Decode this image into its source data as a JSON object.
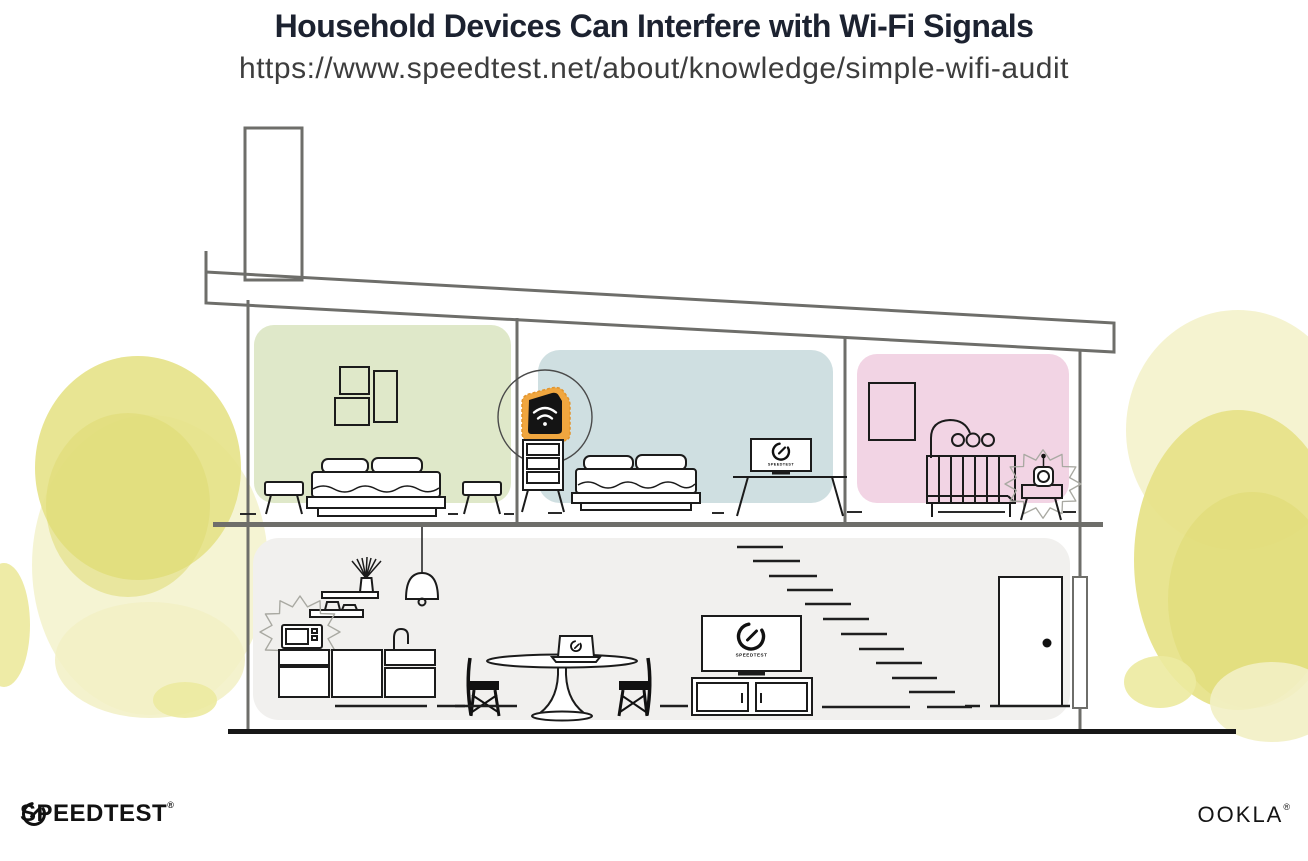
{
  "header": {
    "title": "Household Devices Can Interfere with Wi-Fi Signals",
    "url": "https://www.speedtest.net/about/knowledge/simple-wifi-audit"
  },
  "illustration": {
    "screen_labels": {
      "bedroom_monitor": "SPEEDTEST",
      "tv": "SPEEDTEST"
    },
    "colors": {
      "wall_green": "#dfe8c9",
      "wall_blue": "#cfdfe1",
      "wall_pink": "#f2d4e4",
      "floor_grey": "#f1f0ee",
      "router_orange": "#f0a63f",
      "foliage_yellow": "#e6e287",
      "foliage_yellow_dark": "#dedA72",
      "foliage_yellow_light": "#f2f0c4",
      "structure_line": "#6e6e6a",
      "furniture_line": "#1b1b1b"
    }
  },
  "footer": {
    "speedtest_logo_text": "SPEEDTEST",
    "speedtest_trademark": "®",
    "ookla_logo_text": "OOKLA",
    "ookla_trademark": "®"
  }
}
